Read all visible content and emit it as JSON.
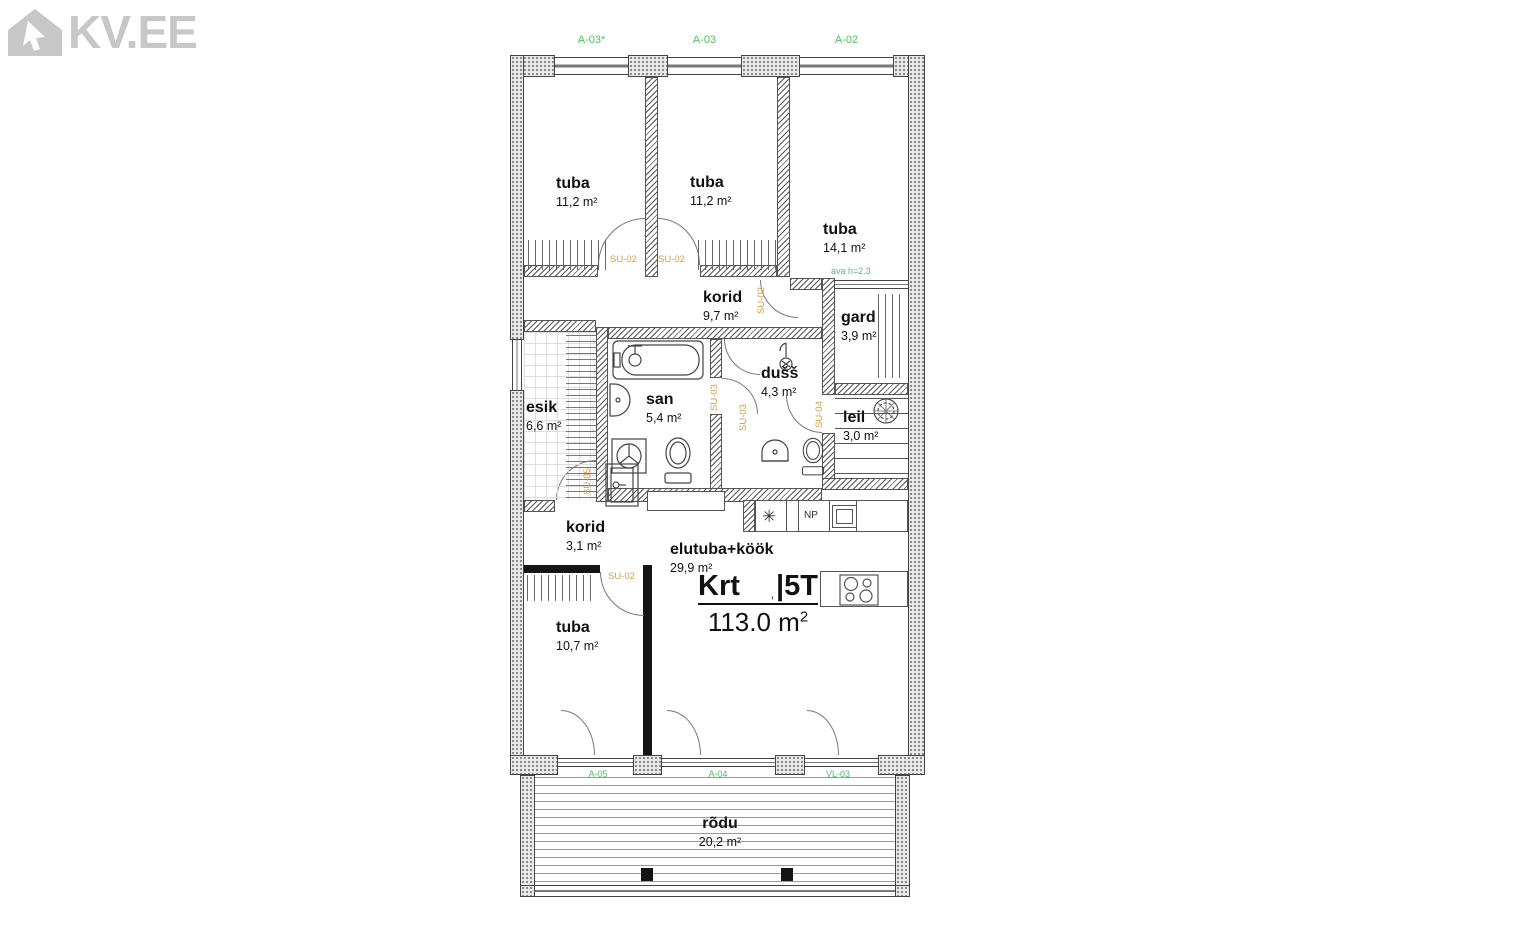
{
  "logo": {
    "text": "KV.EE"
  },
  "colors": {
    "label_green": "#4fbf63",
    "label_orange": "#d2a046",
    "logo_gray": "#c7c7c7",
    "plan_line": "#444444",
    "text_dark": "#111111"
  },
  "plan": {
    "window_labels": [
      "A-03*",
      "A-03",
      "A-02"
    ],
    "balcony_labels": [
      "A-05",
      "A-04",
      "VL-03"
    ],
    "opening_label": "ava h=2.3",
    "np_label": "NP",
    "unit": {
      "name": "Krt",
      "mark": ",",
      "type": "|5T",
      "area_value": "113.0 m",
      "area_sup": "2"
    },
    "door_labels": [
      "SU-02",
      "SU-02",
      "SU-02",
      "SU-03",
      "SU-03",
      "SU-04",
      "SU-05",
      "SU-02"
    ],
    "rooms": [
      {
        "name": "tuba",
        "area": "11,2 m²"
      },
      {
        "name": "tuba",
        "area": "11,2 m²"
      },
      {
        "name": "tuba",
        "area": "14,1 m²"
      },
      {
        "name": "korid",
        "area": "9,7 m²"
      },
      {
        "name": "gard",
        "area": "3,9 m²"
      },
      {
        "name": "dušš",
        "area": "4,3 m²"
      },
      {
        "name": "san",
        "area": "5,4 m²"
      },
      {
        "name": "esik",
        "area": "6,6 m²"
      },
      {
        "name": "leil",
        "area": "3,0 m²"
      },
      {
        "name": "korid",
        "area": "3,1 m²"
      },
      {
        "name": "elutuba+köök",
        "area": "29,9 m²"
      },
      {
        "name": "tuba",
        "area": "10,7 m²"
      },
      {
        "name": "rõdu",
        "area": "20,2 m²"
      }
    ]
  }
}
